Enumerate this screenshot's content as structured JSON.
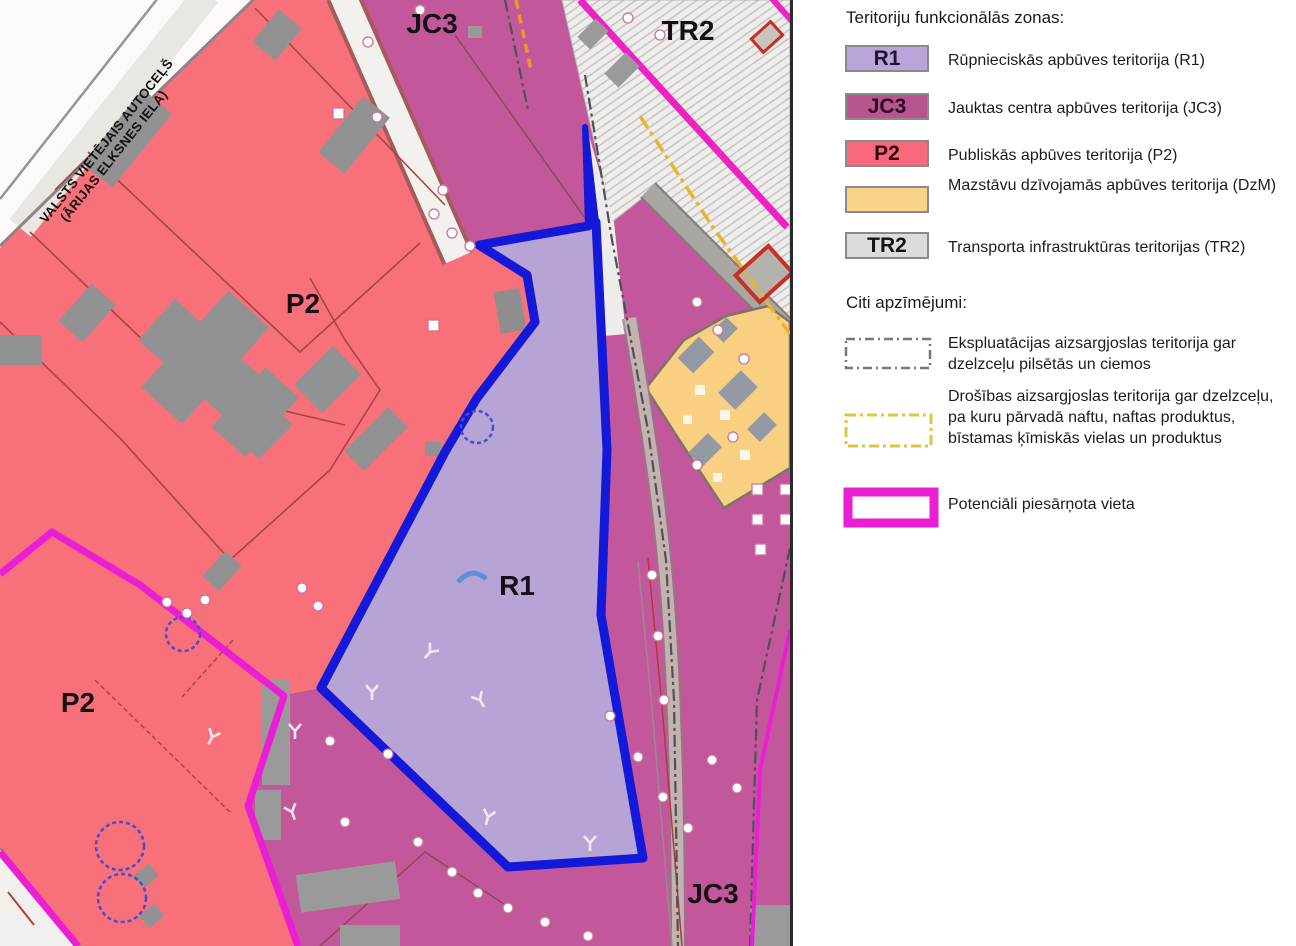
{
  "map": {
    "labels": {
      "jc3_top": "JC3",
      "tr2": "TR2",
      "p2_upper": "P2",
      "p2_lower": "P2",
      "r1": "R1",
      "jc3_bottom": "JC3"
    },
    "road_name_line1": "VALSTS VIETĒJAIS AUTOCEĻŠ",
    "road_name_line2": "(ĀRIJAS ELKSNES IELA)",
    "colors": {
      "r1_zone": "#b6a4d6",
      "jc3_zone": "#c2589b",
      "p2_zone": "#f8707a",
      "dzm_zone": "#f9cf82",
      "tr2_zone": "#efedeb",
      "site_boundary_blue": "#1418d8",
      "contaminated_magenta": "#ea1ed2",
      "railway_stripe_magenta": "#ee22c4",
      "safety_line_yellow": "#e9b42a"
    }
  },
  "legend": {
    "zones_title": "Teritoriju funkcionālās zonas:",
    "zones": [
      {
        "code": "R1",
        "color": "#b9a4dc",
        "label": "Rūpnieciskās apbūves teritorija (R1)"
      },
      {
        "code": "JC3",
        "color": "#b9548e",
        "label": "Jauktas centra apbūves teritorija (JC3)"
      },
      {
        "code": "P2",
        "color": "#f9697c",
        "label": "Publiskās apbūves teritorija (P2)"
      },
      {
        "code": "",
        "color": "#f8d389",
        "label": "Mazstāvu dzīvojamās apbūves teritorija (DzM)"
      },
      {
        "code": "TR2",
        "color": "#dedcda",
        "label": "Transporta infrastruktūras teritorijas (TR2)"
      }
    ],
    "other_title": "Citi apzīmējumi:",
    "other": [
      {
        "symbol": "gray-dashdot-rect",
        "label": "Ekspluatācijas aizsargjoslas teritorija gar dzelzceļu pilsētās un ciemos"
      },
      {
        "symbol": "yellow-dashdot-rect",
        "label": "Drošības aizsargjoslas teritorija gar dzelzceļu, pa kuru pārvadā naftu, naftas produktus, bīstamas ķīmiskās vielas un produktus"
      },
      {
        "symbol": "magenta-rect",
        "label": "Potenciāli piesārņota vieta"
      }
    ]
  }
}
